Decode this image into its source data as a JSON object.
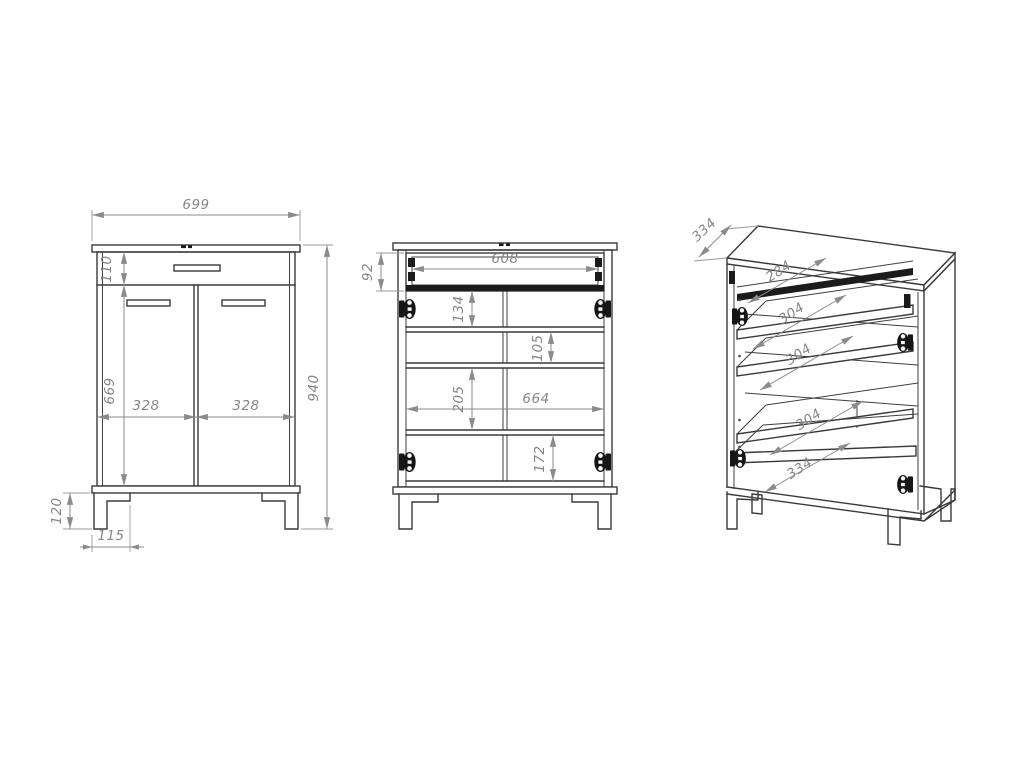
{
  "colors": {
    "background": "#ffffff",
    "outline": "#3a3a3a",
    "dimension_gray": "#8b8b8b",
    "dark_fill": "#1b1b1b"
  },
  "front_view": {
    "width": "699",
    "drawer_front_height": "110",
    "door_height": "669",
    "left_door_width": "328",
    "right_door_width": "328",
    "total_height": "940",
    "leg_height": "120",
    "leg_offset": "115"
  },
  "inside_view": {
    "drawer_box_height": "92",
    "drawer_inner_width": "608",
    "top_section_height": "134",
    "second_section_height": "105",
    "third_section_height": "205",
    "interior_width": "664",
    "bottom_section_height": "172"
  },
  "perspective_view": {
    "top_depth": "334",
    "top_shelf_depth": "284",
    "upper_shelf_depth": "304",
    "middle_shelf_depth": "304",
    "lower_shelf_depth": "304",
    "bottom_shelf_depth": "334"
  }
}
